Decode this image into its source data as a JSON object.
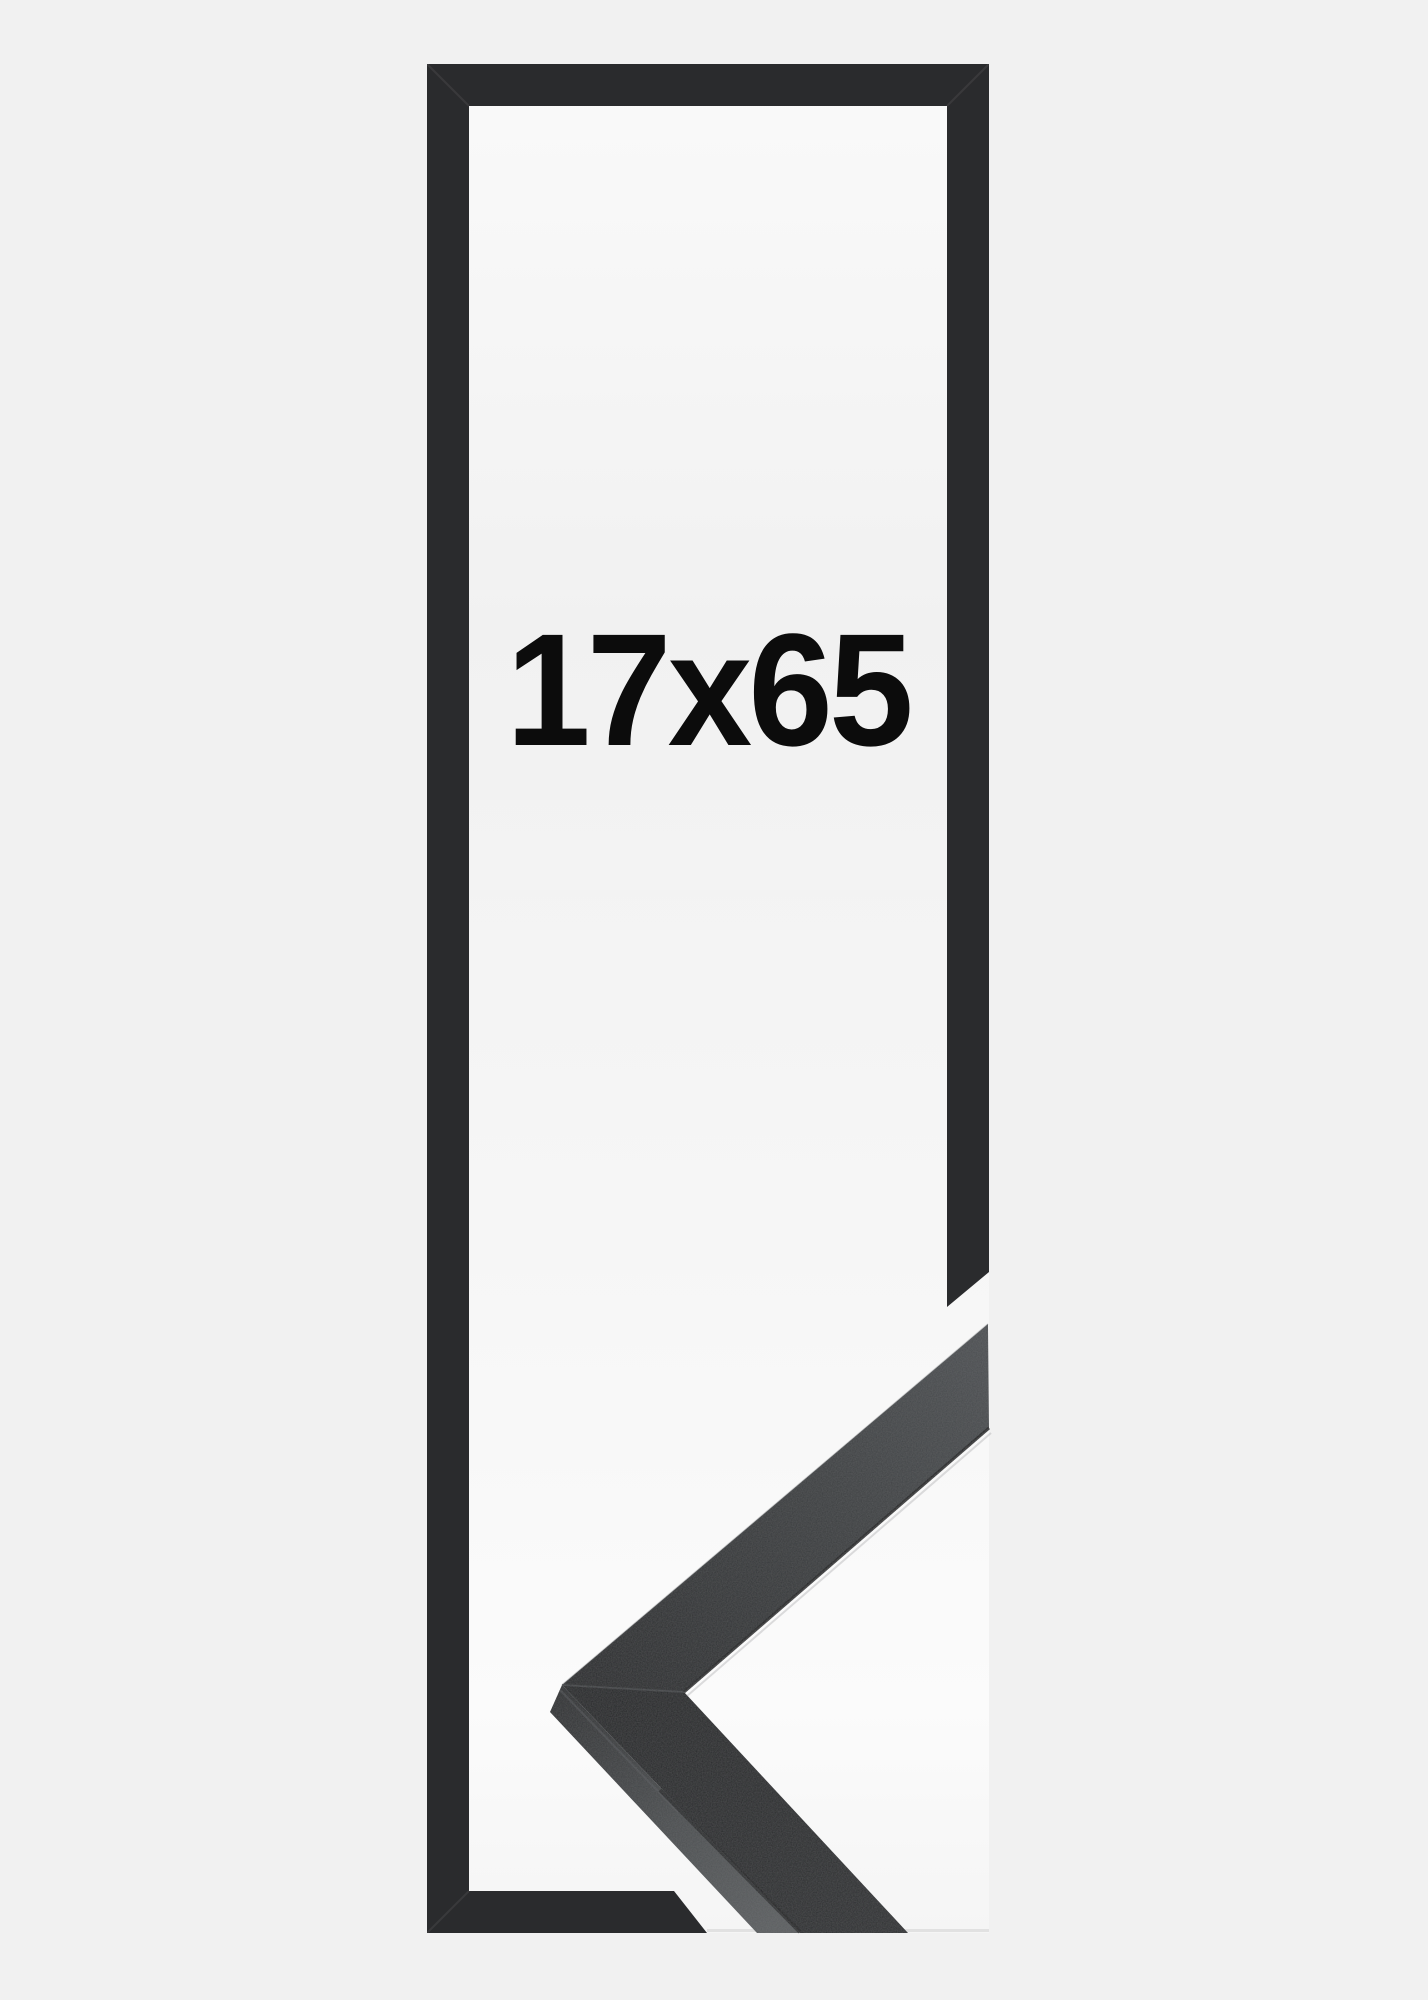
{
  "product_image": {
    "size_label": "17x65",
    "colors": {
      "background": "#f1f1f1",
      "backing_panel": "#f7f7f7",
      "outline_bars": "#2a2b2d",
      "moulding_front_dark": "#232527",
      "moulding_front_light": "#4c4f52",
      "moulding_side_face": "#585b5d",
      "label_text": "#0c0c0c"
    }
  }
}
